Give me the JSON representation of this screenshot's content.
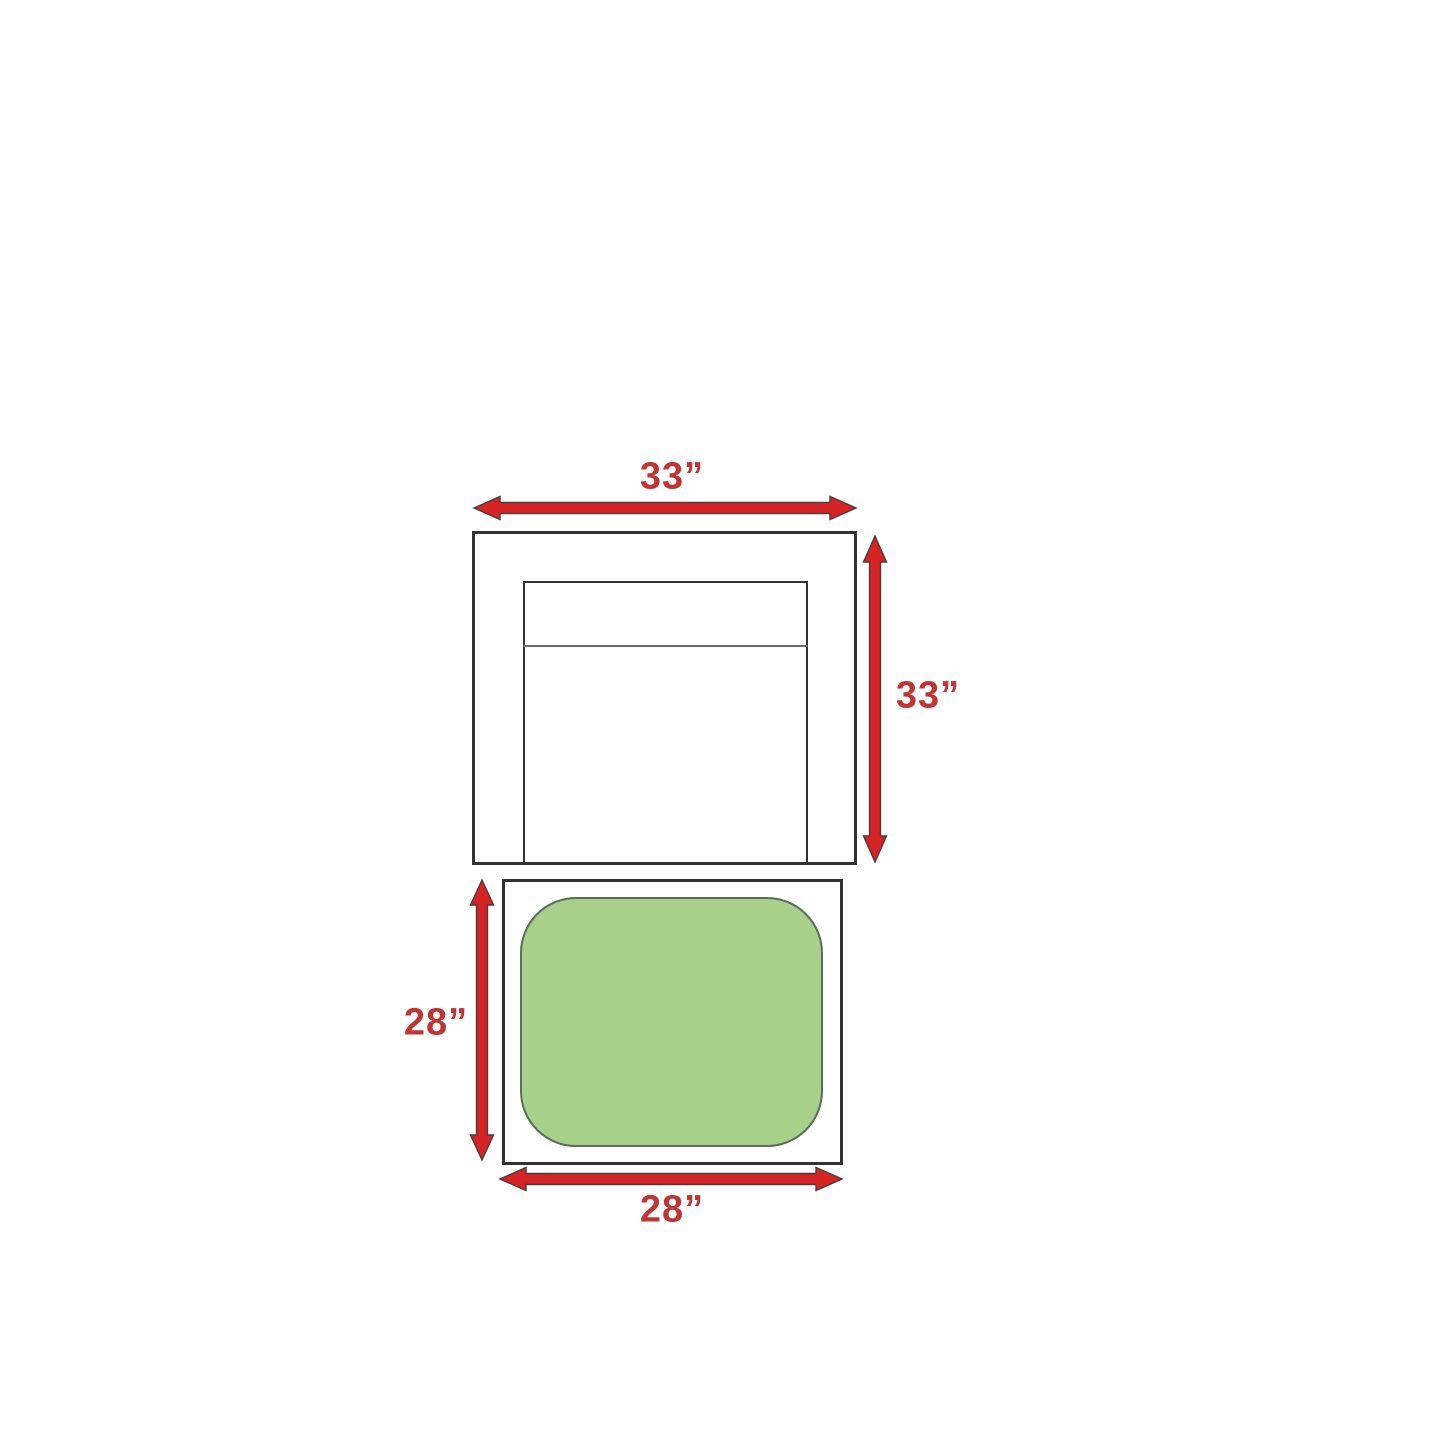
{
  "diagram": {
    "labels": {
      "top_width": "33”",
      "right_height": "33”",
      "left_height": "28”",
      "bottom_width": "28”"
    },
    "pieces": {
      "armchair": {
        "width": "33”",
        "depth": "33”"
      },
      "ottoman": {
        "width": "28”",
        "depth": "28”"
      }
    },
    "icons": {
      "horizontal_double_arrow": "double-headed horizontal dimension arrow",
      "vertical_double_arrow": "double-headed vertical dimension arrow"
    },
    "colors": {
      "arrow_red": "#d62424",
      "arrow_outline": "#4a3c3c",
      "label_red": "#c03434",
      "box_border": "#333333",
      "divider_gray": "#6b6b6b",
      "cushion_green": "#a7d08b",
      "cushion_border": "#5c6b5c",
      "background": "#ffffff"
    }
  }
}
